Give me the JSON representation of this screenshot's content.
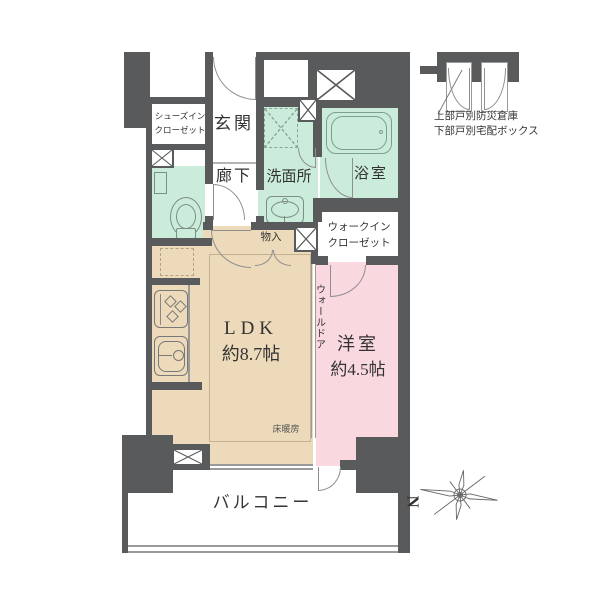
{
  "colors": {
    "wall": "#595a5c",
    "wet_room": "#cbecdb",
    "living": "#ecdaba",
    "bedroom": "#f9d8df",
    "text": "#333333"
  },
  "rooms": {
    "entrance": {
      "label": "玄関"
    },
    "hallway": {
      "label": "廊下"
    },
    "washroom": {
      "label": "洗面所"
    },
    "bathroom": {
      "label": "浴室"
    },
    "shoes_in_closet": {
      "line1": "シューズイン",
      "line2": "クローゼット"
    },
    "walk_in_closet": {
      "line1": "ウォークイン",
      "line2": "クローゼット"
    },
    "ldk": {
      "name": "LDK",
      "size": "約8.7帖"
    },
    "bedroom": {
      "name": "洋室",
      "size": "約4.5帖"
    },
    "storage": {
      "label": "物入"
    },
    "wall_door": {
      "label": "ウォールドア"
    },
    "floor_heating": {
      "label": "床暖房"
    },
    "balcony": {
      "label": "バルコニー"
    }
  },
  "annex": {
    "line1": "上部戸別防災倉庫",
    "line2": "下部戸別宅配ボックス"
  },
  "compass": {
    "north": "N"
  }
}
